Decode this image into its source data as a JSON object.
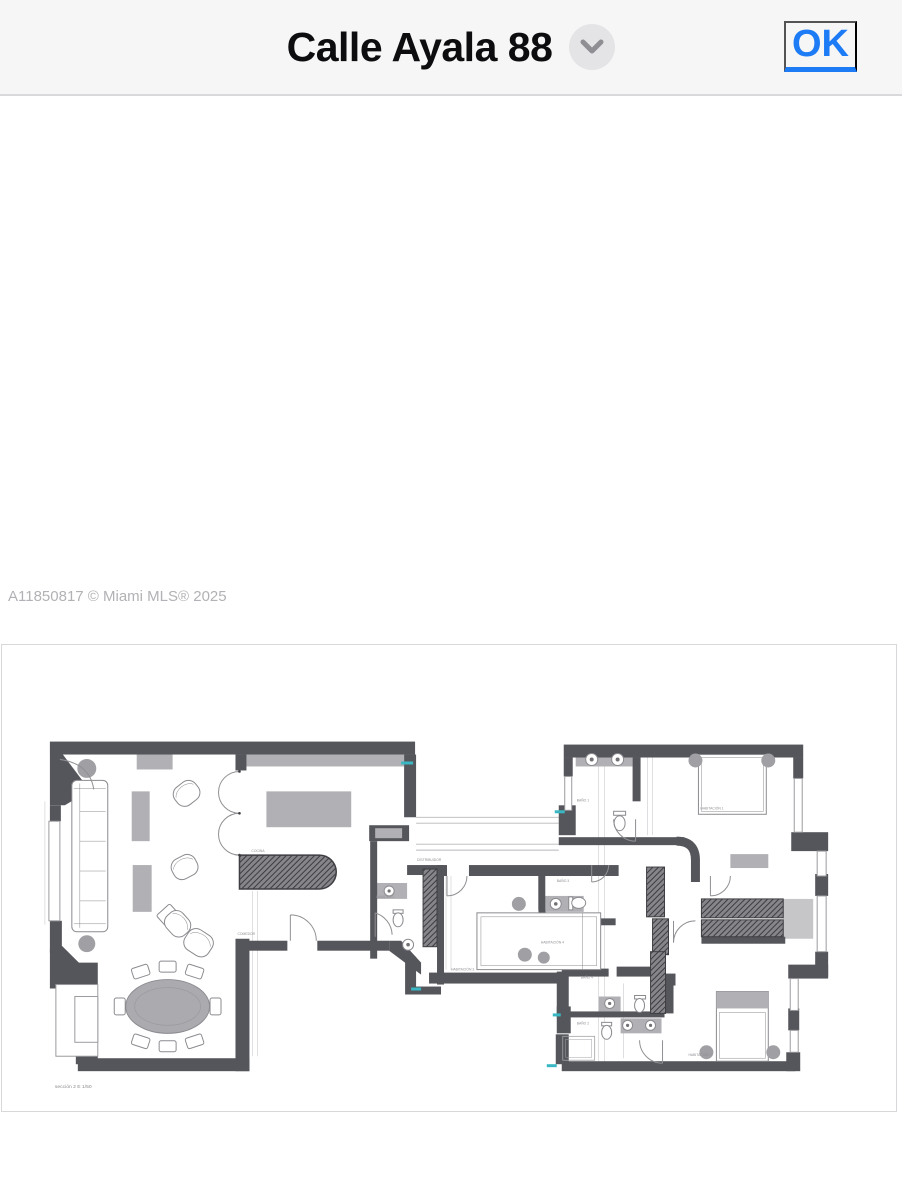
{
  "header": {
    "title": "Calle Ayala 88",
    "ok_label": "OK",
    "chevron_icon": "chevron-down"
  },
  "watermark": "A11850817 © Miami MLS® 2025",
  "floor_plan": {
    "caption": "sección 2 E 1/50",
    "rooms": {
      "cocina": "COCINA",
      "comedor": "COMEDOR",
      "distribuidor": "DISTRIBUIDOR",
      "lavadero": "LAVADERO",
      "habitacion_1": "HABITACIÓN 1",
      "habitacion_2": "HABITACIÓN 2",
      "habitacion_3": "HABITACIÓN 3",
      "habitacion_4": "HABITACIÓN 4",
      "bano_1": "BAÑO 1",
      "bano_2": "BAÑO 2",
      "bano_3": "BAÑO 3",
      "bano_4": "BAÑO 4"
    }
  },
  "colors": {
    "accent_blue": "#1d7cf5",
    "header_bg": "#f6f6f7",
    "wall_gray": "#55565b",
    "watermark_gray": "#b2b2b6",
    "marker_teal": "#39b8c4"
  }
}
